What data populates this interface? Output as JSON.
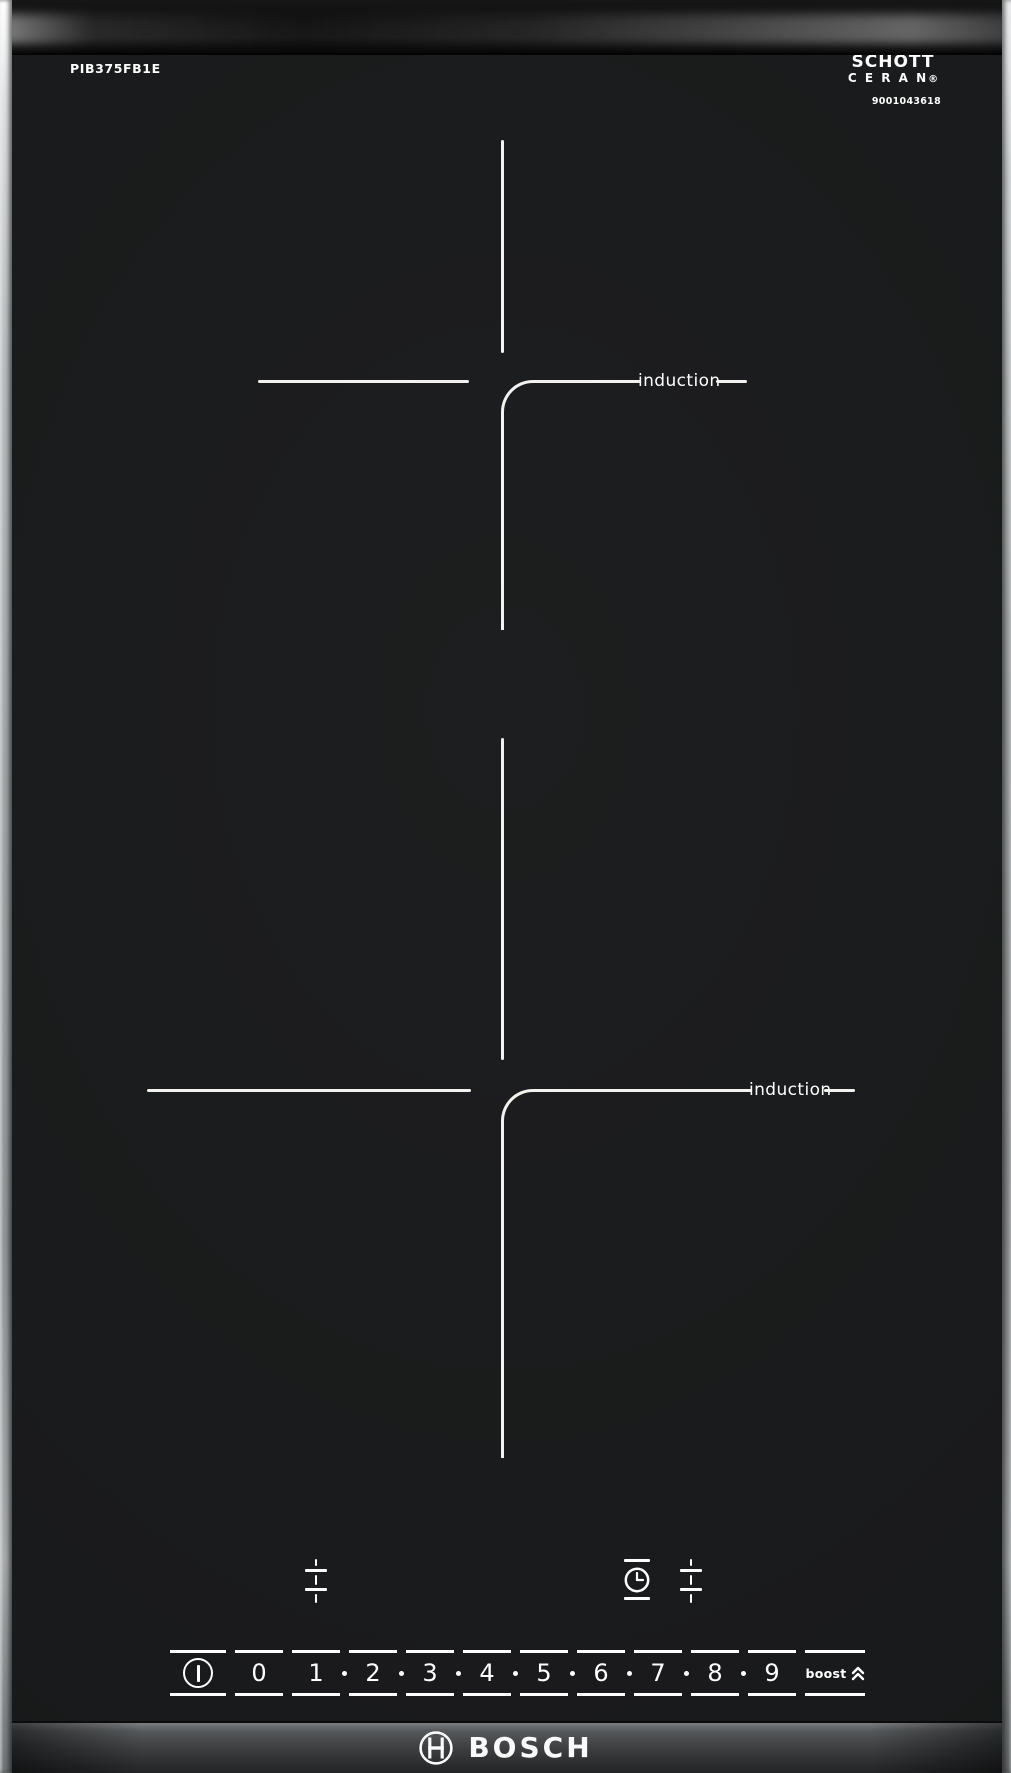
{
  "product": {
    "model": "PIB375FB1E",
    "brand": "BOSCH",
    "glass_brand_line1": "SCHOTT",
    "glass_brand_line2": "C E R A N",
    "glass_brand_registered": "®",
    "code": "9001043618"
  },
  "zones": [
    {
      "id": "rear",
      "label": "induction"
    },
    {
      "id": "front",
      "label": "induction"
    }
  ],
  "control_panel": {
    "power_key_icon": "power-icon",
    "levels": [
      "0",
      "1",
      "2",
      "3",
      "4",
      "5",
      "6",
      "7",
      "8",
      "9"
    ],
    "boost_label": "boost",
    "keys": [
      {
        "icon": "zone-select-left-icon"
      },
      {
        "icon": "timer-icon"
      },
      {
        "icon": "zone-select-right-icon"
      }
    ]
  },
  "colors": {
    "glass": "#1b1c1d",
    "marking": "#f4f2ee",
    "trim": "#c7cacc",
    "bottom_band": "#46484a"
  }
}
